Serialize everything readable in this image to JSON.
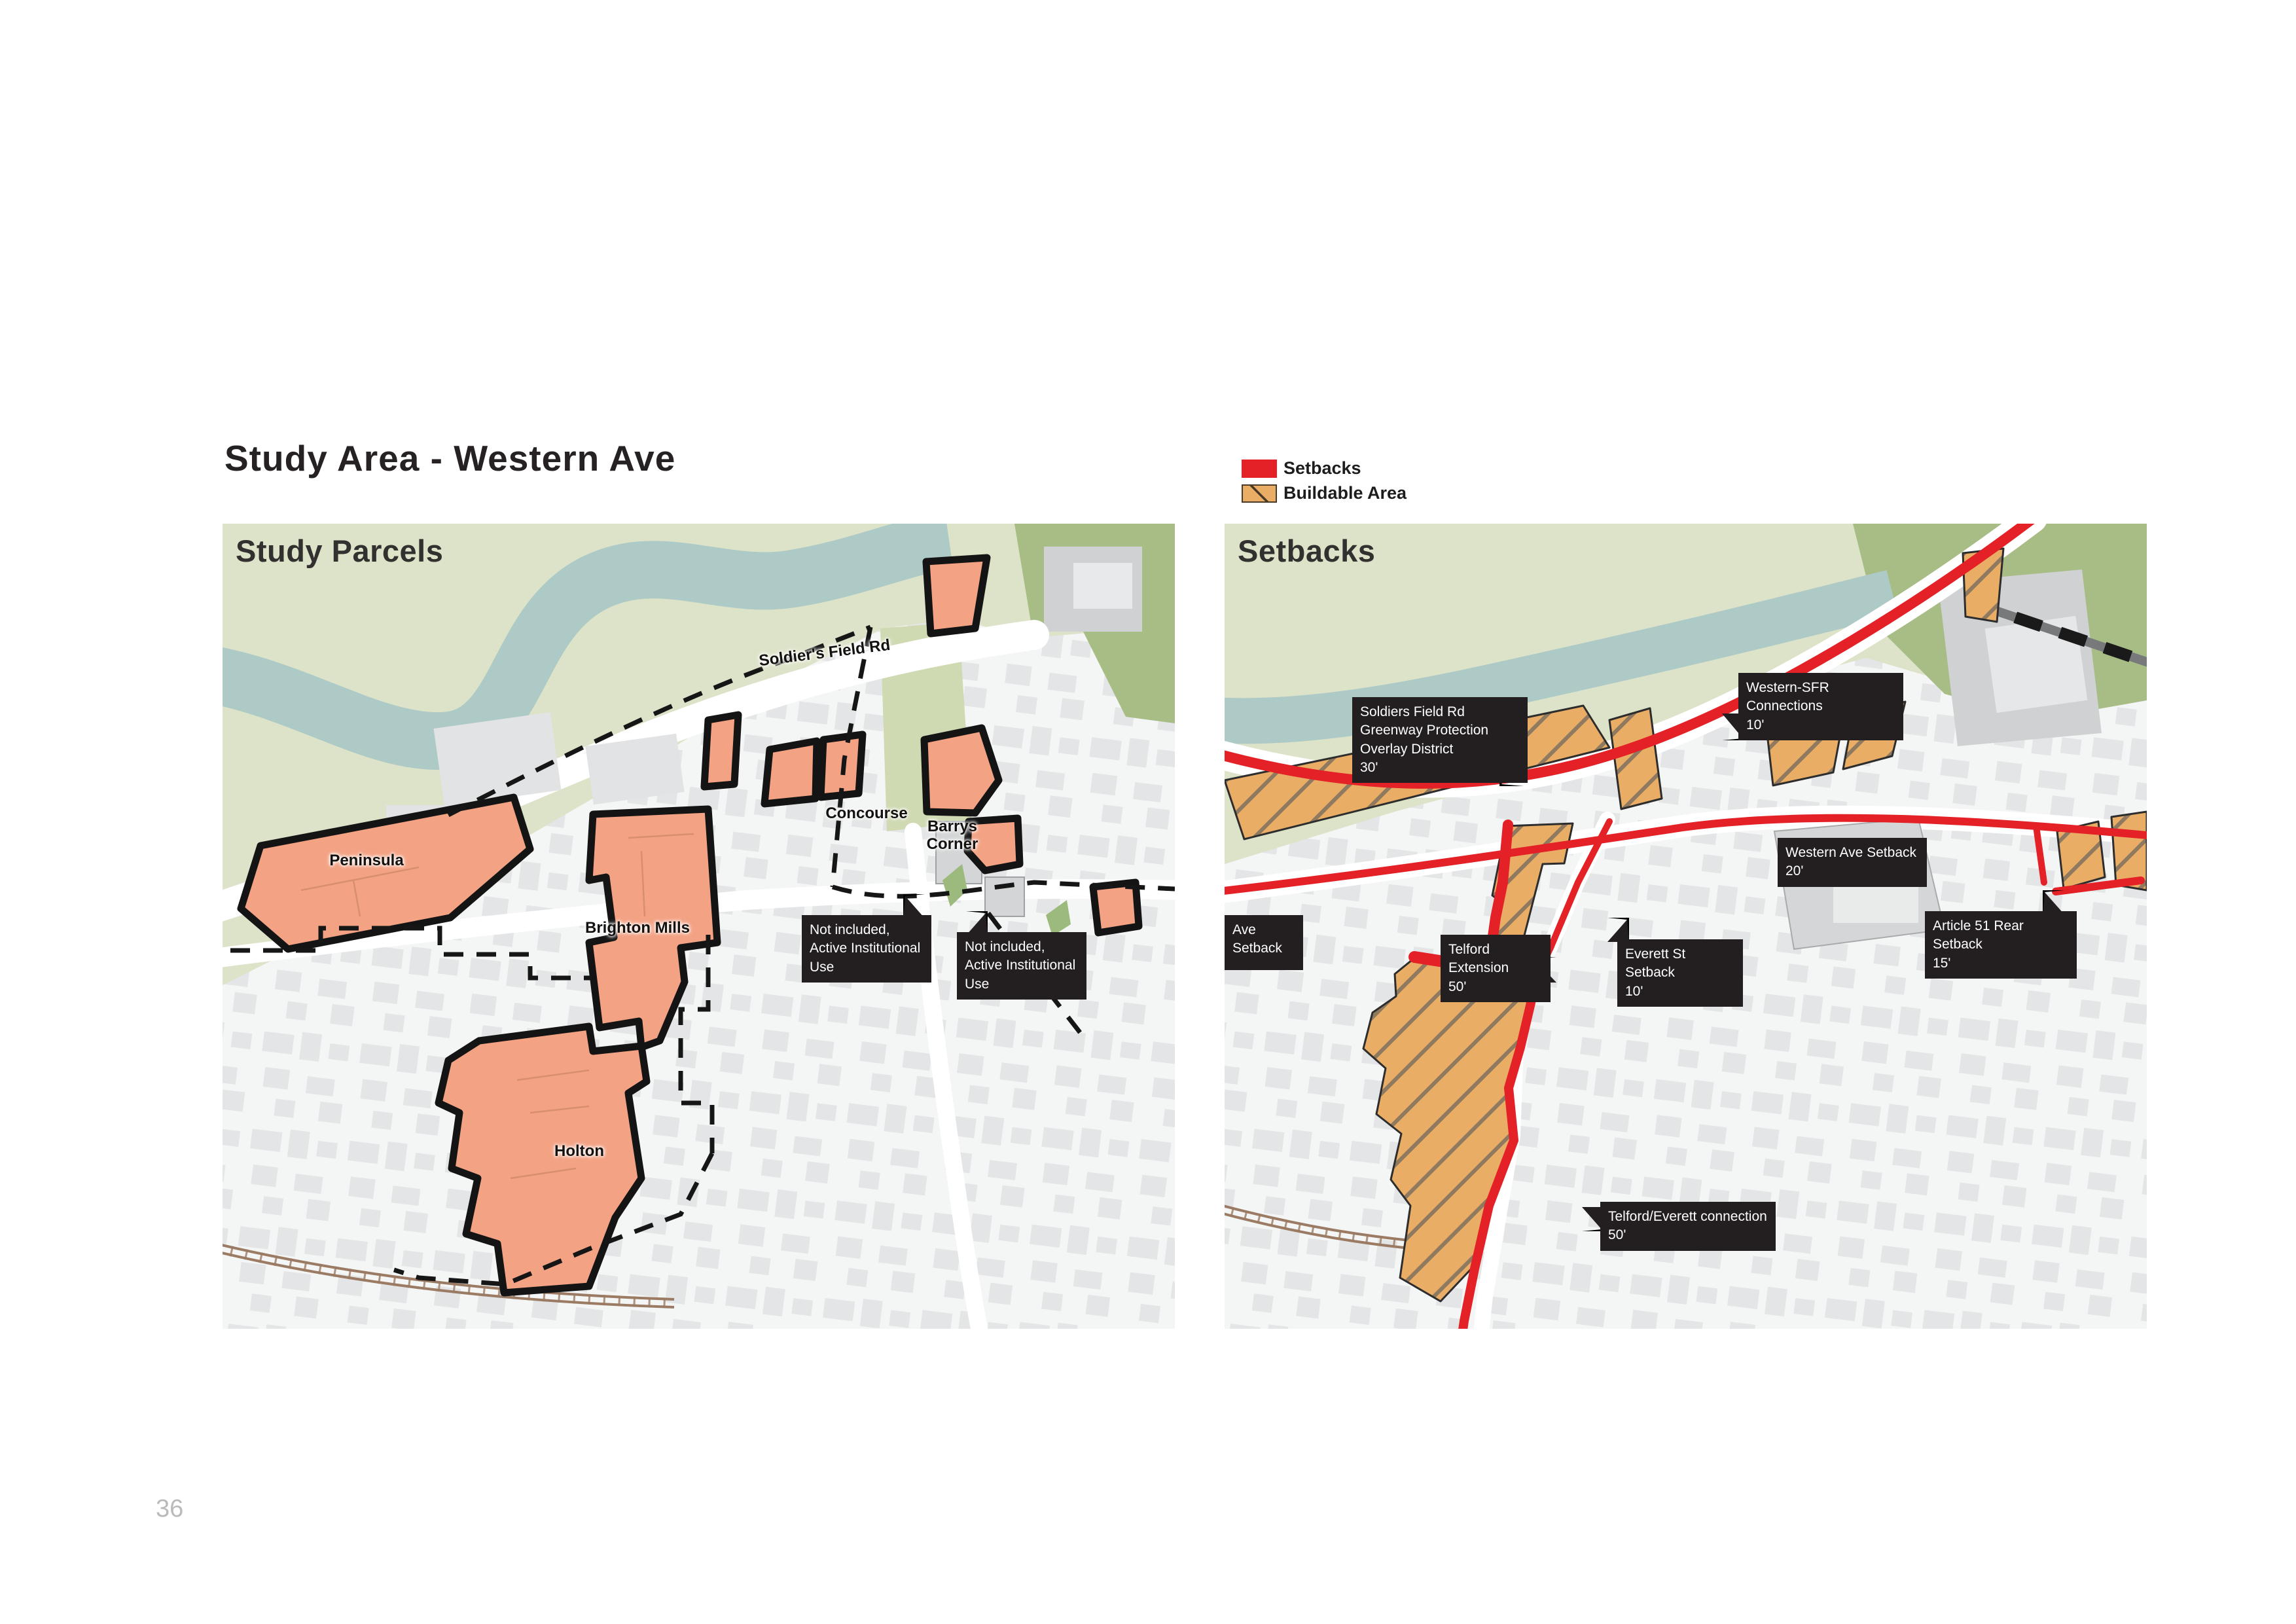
{
  "page": {
    "title": "Study Area - Western Ave",
    "page_number": "36"
  },
  "legend": {
    "setbacks_label": "Setbacks",
    "buildable_label": "Buildable Area"
  },
  "left_map": {
    "heading": "Study Parcels",
    "streets": {
      "soldiers_field_rd": "Soldier's Field Rd",
      "concourse": "Concourse",
      "barrys_corner": "Barrys Corner"
    },
    "parcels": {
      "peninsula": "Peninsula",
      "brighton_mills": "Brighton Mills",
      "holton": "Holton"
    },
    "notes": {
      "not_included_1": "Not included, Active Institutional Use",
      "not_included_2": "Not included, Active Institutional Use"
    }
  },
  "right_map": {
    "heading": "Setbacks",
    "annotations": {
      "greenway": {
        "label": "Soldiers Field Rd Greenway Protection Overlay District",
        "value": "30'"
      },
      "western_sfr": {
        "label": "Western-SFR Connections",
        "value": "10'"
      },
      "western_ave": {
        "label": "Western Ave Setback",
        "value": "20'"
      },
      "ave_setback": {
        "label": "Ave Setback",
        "value": ""
      },
      "telford_ext": {
        "label": "Telford Extension",
        "value": "50'"
      },
      "everett": {
        "label": "Everett St Setback",
        "value": "10'"
      },
      "article51": {
        "label": "Article 51 Rear Setback",
        "value": "15'"
      },
      "telford_everett": {
        "label": "Telford/Everett connection",
        "value": "50'"
      }
    }
  },
  "colors": {
    "setback_red": "#e32126",
    "buildable_tan": "#e9ad66",
    "parcel_salmon": "#f3a284",
    "park_green": "#dde3c8",
    "field_green": "#a8bd85",
    "river_blue": "#aecac6",
    "annotation_bg": "#231f20"
  }
}
